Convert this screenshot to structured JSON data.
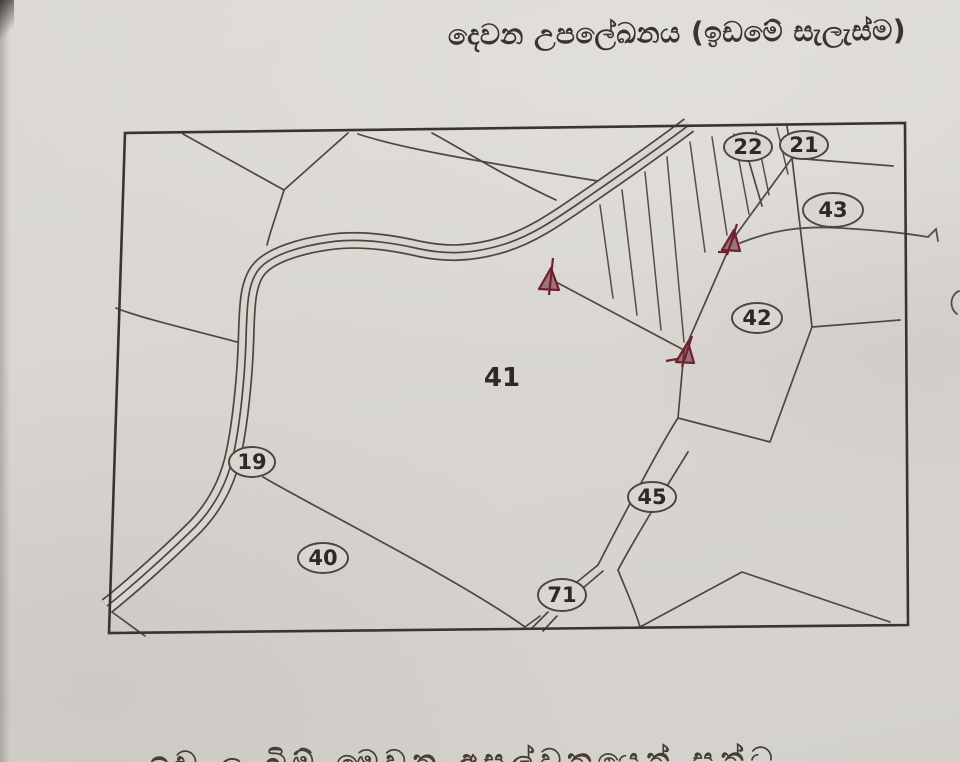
{
  "title": "දෙවන උපලේඛනය (ඉඩමේ සැලැස්ම)",
  "bottom_text_partial": "ඉඩ ල බිම් මෙවන අසල්වතයෙන් සන්ධ",
  "map": {
    "description": "hand-drawn cadastral land plan",
    "paper_color": "#d9d6d2",
    "ink_color": "#4f453c",
    "border_color": "#3a332e",
    "number_color": "#2f2823",
    "survey_marker_color": "#6e2130",
    "survey_marker_count": 3,
    "road_style": "triple-line",
    "hatched_area": "between road and lots 21/22 boundary",
    "lots": [
      {
        "number": "22",
        "shape": "ellipse",
        "cx": 748,
        "cy": 147,
        "rx": 24,
        "ry": 14
      },
      {
        "number": "21",
        "shape": "ellipse",
        "cx": 804,
        "cy": 145,
        "rx": 24,
        "ry": 14
      },
      {
        "number": "43",
        "shape": "ellipse",
        "cx": 833,
        "cy": 210,
        "rx": 30,
        "ry": 17
      },
      {
        "number": "42",
        "shape": "ellipse",
        "cx": 757,
        "cy": 318,
        "rx": 25,
        "ry": 15
      },
      {
        "number": "41",
        "shape": "plain",
        "cx": 502,
        "cy": 378
      },
      {
        "number": "19",
        "shape": "ellipse",
        "cx": 252,
        "cy": 462,
        "rx": 23,
        "ry": 15
      },
      {
        "number": "40",
        "shape": "ellipse",
        "cx": 323,
        "cy": 558,
        "rx": 25,
        "ry": 15
      },
      {
        "number": "45",
        "shape": "ellipse",
        "cx": 652,
        "cy": 497,
        "rx": 24,
        "ry": 15
      },
      {
        "number": "71",
        "shape": "ellipse",
        "cx": 562,
        "cy": 595,
        "rx": 24,
        "ry": 16
      }
    ]
  }
}
